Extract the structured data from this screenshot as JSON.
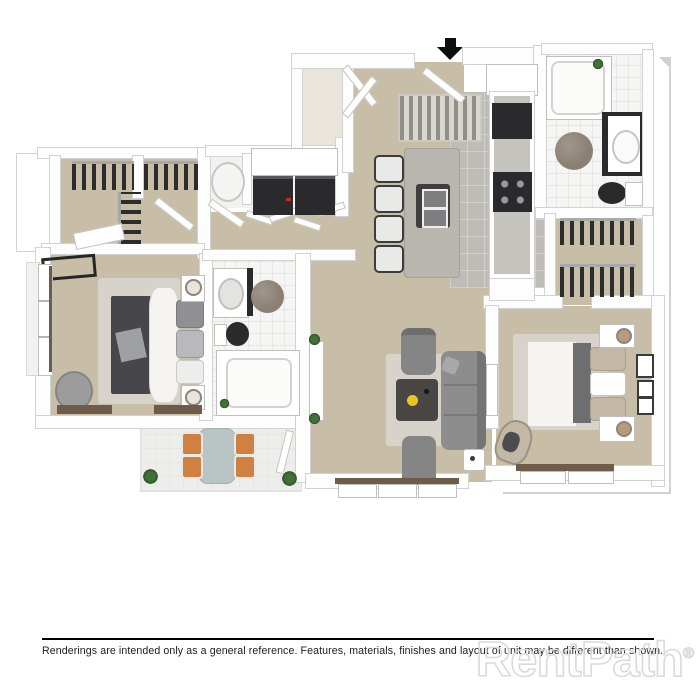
{
  "footer": {
    "disclaimer": "Renderings are intended only as a general reference. Features, materials, finishes and layout of unit may be different than shown.",
    "watermark": "RentPath",
    "registered_mark": "®"
  },
  "floorplan": {
    "entry_arrow_icon": "black-down-arrow",
    "colors": {
      "wall": "#fdfdfd",
      "wall_edge": "#d2d2d2",
      "carpet": "#c8bda7",
      "bath_tile": "#f5f5f3",
      "kitchen_tile": "#bdbcb6",
      "patio_floor": "#ededeb",
      "appliance_dark": "#2a2a2c",
      "island_top": "#b8b6ae",
      "sofa_gray": "#8d8d8d",
      "chair_gray": "#858585",
      "duvet_dark": "#47474b",
      "linen_white": "#f5f4f1",
      "pillow_tan": "#c3b8a5",
      "runner_gray": "#6e6e71",
      "accent_orange": "#d08040",
      "accent_yellow": "#e9c71e",
      "patio_table": "#b9c5c5",
      "round_rug": "#8b8073",
      "wood_brown": "#6f5b49",
      "plant_green": "#41703a",
      "rug_light": "#d8d3ca",
      "divider_black": "#000000",
      "text_black": "#1c1c1c",
      "watermark_gray": "#dadada"
    }
  }
}
